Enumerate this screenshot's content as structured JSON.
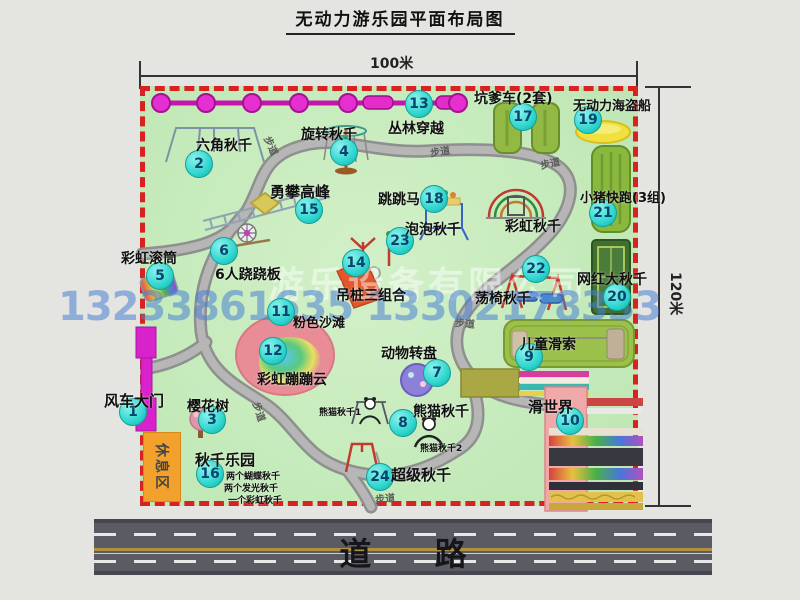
{
  "title": "无动力游乐园平面布局图",
  "dimensions": {
    "width": "100米",
    "height": "120米"
  },
  "road": {
    "label": "道  路"
  },
  "watermark": {
    "company": "游乐设备有限公司",
    "phones": "13233861635 13302178333"
  },
  "colors": {
    "park_green": "#c6ebbc",
    "border_red": "#d82222",
    "badge_teal": "#2fd6cf",
    "chain_magenta": "#e32cc8",
    "gate_magenta": "#d822cc",
    "rest_area_orange": "#f2a12c",
    "road_gray": "#5b5b63",
    "watermark_blue": "#487fd4",
    "path_gray": "#a2a2a2"
  },
  "map": {
    "rest_area_label": "休息区",
    "walkway_label": "步道",
    "walkway_label_positions": [
      {
        "x": 262,
        "y": 138,
        "rot": 65
      },
      {
        "x": 430,
        "y": 143,
        "rot": -8
      },
      {
        "x": 540,
        "y": 155,
        "rot": -12
      },
      {
        "x": 455,
        "y": 315,
        "rot": 5
      },
      {
        "x": 250,
        "y": 404,
        "rot": 72
      },
      {
        "x": 375,
        "y": 490,
        "rot": -5
      }
    ],
    "attractions": [
      {
        "num": 1,
        "label": "风车大门",
        "bx": 133,
        "by": 412,
        "lx": 104,
        "ly": 390,
        "fs": 15
      },
      {
        "num": 2,
        "label": "六角秋千",
        "bx": 199,
        "by": 164,
        "lx": 196,
        "ly": 135,
        "fs": 14
      },
      {
        "num": 3,
        "label": "樱花树",
        "bx": 212,
        "by": 420,
        "lx": 187,
        "ly": 396,
        "fs": 14
      },
      {
        "num": 4,
        "label": "旋转秋千",
        "bx": 344,
        "by": 152,
        "lx": 301,
        "ly": 124,
        "fs": 14
      },
      {
        "num": 5,
        "label": "彩虹滚筒",
        "bx": 160,
        "by": 276,
        "lx": 121,
        "ly": 248,
        "fs": 14
      },
      {
        "num": 6,
        "label": "6人跷跷板",
        "bx": 224,
        "by": 251,
        "lx": 215,
        "ly": 264,
        "fs": 14
      },
      {
        "num": 7,
        "label": "动物转盘",
        "bx": 437,
        "by": 373,
        "lx": 381,
        "ly": 343,
        "fs": 14
      },
      {
        "num": 8,
        "label": "熊猫秋千",
        "bx": 403,
        "by": 423,
        "lx": 413,
        "ly": 401,
        "fs": 14
      },
      {
        "num": 9,
        "label": "儿童滑索",
        "bx": 529,
        "by": 357,
        "lx": 520,
        "ly": 334,
        "fs": 14
      },
      {
        "num": 10,
        "label": "滑世界",
        "bx": 570,
        "by": 421,
        "lx": 528,
        "ly": 396,
        "fs": 15
      },
      {
        "num": 11,
        "label": "粉色沙滩",
        "bx": 281,
        "by": 312,
        "lx": 293,
        "ly": 312,
        "fs": 13
      },
      {
        "num": 12,
        "label": "彩虹蹦蹦云",
        "bx": 273,
        "by": 351,
        "lx": 257,
        "ly": 369,
        "fs": 14
      },
      {
        "num": 13,
        "label": "丛林穿越",
        "bx": 419,
        "by": 104,
        "lx": 388,
        "ly": 118,
        "fs": 14
      },
      {
        "num": 14,
        "label": "吊桩三组合",
        "bx": 356,
        "by": 263,
        "lx": 336,
        "ly": 285,
        "fs": 14
      },
      {
        "num": 15,
        "label": "勇攀高峰",
        "bx": 309,
        "by": 210,
        "lx": 270,
        "ly": 181,
        "fs": 15
      },
      {
        "num": 16,
        "label": "秋千乐园",
        "bx": 210,
        "by": 474,
        "lx": 195,
        "ly": 449,
        "fs": 15
      },
      {
        "num": 17,
        "label": "坑爹车(2套)",
        "bx": 523,
        "by": 117,
        "lx": 474,
        "ly": 88,
        "fs": 14
      },
      {
        "num": 18,
        "label": "跳跳马",
        "bx": 434,
        "by": 199,
        "lx": 378,
        "ly": 189,
        "fs": 14
      },
      {
        "num": 19,
        "label": "无动力海盗船",
        "bx": 588,
        "by": 120,
        "lx": 573,
        "ly": 95,
        "fs": 13
      },
      {
        "num": 20,
        "label": "网红大秋千",
        "bx": 617,
        "by": 297,
        "lx": 577,
        "ly": 269,
        "fs": 14
      },
      {
        "num": 21,
        "label": "小猪快跑(3组)",
        "bx": 603,
        "by": 213,
        "lx": 580,
        "ly": 187,
        "fs": 13
      },
      {
        "num": 22,
        "label": "荡椅秋千",
        "bx": 536,
        "by": 269,
        "lx": 475,
        "ly": 288,
        "fs": 14
      },
      {
        "num": 23,
        "label": "泡泡秋千",
        "bx": 400,
        "by": 241,
        "lx": 405,
        "ly": 219,
        "fs": 14
      },
      {
        "num": 24,
        "label": "超级秋千",
        "bx": 380,
        "by": 477,
        "lx": 391,
        "ly": 464,
        "fs": 15
      }
    ],
    "extra_labels": [
      {
        "name": "rainbow-swing-label",
        "text": "彩虹秋千",
        "x": 505,
        "y": 216,
        "fs": 14
      },
      {
        "name": "panda-swing-1-label",
        "text": "熊猫秋千1",
        "x": 319,
        "y": 405,
        "fs": 9
      },
      {
        "name": "panda-swing-2-label",
        "text": "熊猫秋千2",
        "x": 420,
        "y": 441,
        "fs": 9
      },
      {
        "name": "swing-park-note-1",
        "text": "两个蝴蝶秋千",
        "x": 226,
        "y": 469,
        "fs": 9
      },
      {
        "name": "swing-park-note-2",
        "text": "两个发光秋千",
        "x": 224,
        "y": 481,
        "fs": 9
      },
      {
        "name": "swing-park-note-3",
        "text": "一个彩虹秋千",
        "x": 228,
        "y": 493,
        "fs": 9
      }
    ]
  }
}
